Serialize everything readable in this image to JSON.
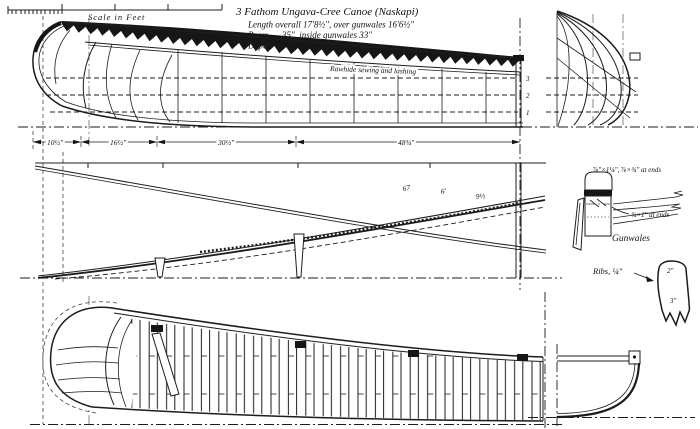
{
  "scale_bar": {
    "label": "Scale in Feet"
  },
  "title_block": {
    "title": "3 Fathom Ungava-Cree Canoe (Naskapi)",
    "length": "Length overall 17'8½\", over gunwales 16'6½\"",
    "beam": "Beam      35\", inside gunwales 33\"",
    "depth": "Depth     14¾\"."
  },
  "profile_view": {
    "lashing_note": "Rawhide sewing and lashing",
    "waterline_labels": [
      "3",
      "2",
      "1"
    ]
  },
  "dimension_line": {
    "segments": [
      "10½\"",
      "16½\"",
      "30½\"",
      "48¾\""
    ]
  },
  "sheer_plan": {
    "offset_notes": [
      "67",
      "6'",
      "9½"
    ]
  },
  "gunwale_detail": {
    "size_main": "⅞\"×1¼\", ⅞×¾\" at ends",
    "size_ends": "¾×1\" at ends",
    "label": "Gunwales"
  },
  "rib_detail": {
    "label": "Ribs, ¼\"",
    "top_width": "2\"",
    "blade_width": "3\""
  }
}
